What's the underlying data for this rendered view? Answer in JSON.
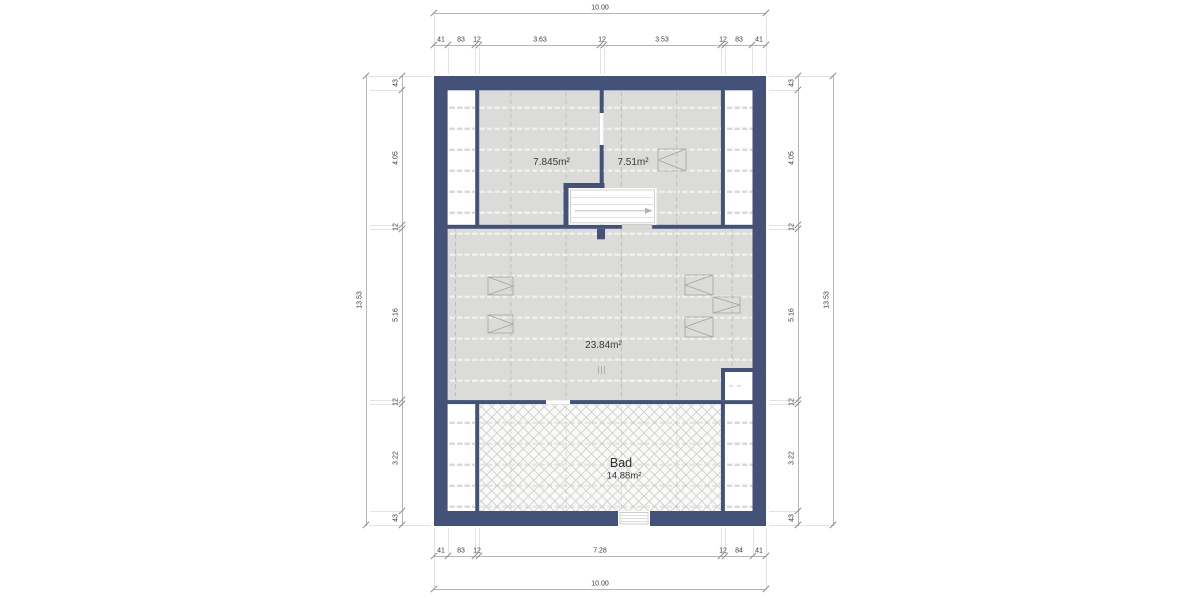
{
  "dims": {
    "top_overall": "10.00",
    "top_chain": [
      "41",
      "83",
      "12",
      "3.63",
      "12",
      "3.53",
      "12",
      "83",
      "41"
    ],
    "bottom_chain": [
      "41",
      "83",
      "12",
      "7.28",
      "12",
      "84",
      "41"
    ],
    "bottom_overall": "10.00",
    "left_overall": "13.53",
    "left_chain": [
      "43",
      "4.05",
      "12",
      "5.16",
      "12",
      "3.22",
      "43"
    ],
    "right_overall": "13.53",
    "right_chain": [
      "43",
      "4.05",
      "12",
      "5.16",
      "12",
      "3.22",
      "43"
    ]
  },
  "rooms": {
    "top_left_area": "7.845m²",
    "top_right_area": "7.51m²",
    "middle_area": "23.84m²",
    "bad_name": "Bad",
    "bad_area": "14.88m²"
  },
  "colors": {
    "wall": "#44527a",
    "floor_fill": "#dbdbd9",
    "hatch_line": "#cdcdcb",
    "dimension_line": "#b6b6b4",
    "text": "#3a3a3a"
  }
}
